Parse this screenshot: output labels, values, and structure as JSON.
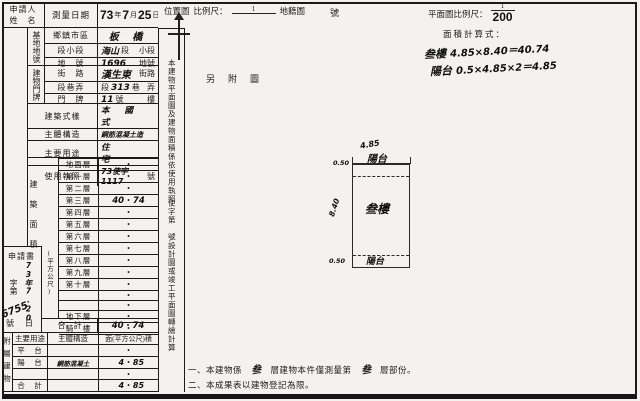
{
  "header": {
    "applicant_line1": "申請人",
    "applicant_line2": "姓　名",
    "survey_date_label": "測量日期",
    "date_year": "73",
    "date_year_unit": "年",
    "date_month": "7",
    "date_month_unit": "月",
    "date_day": "25",
    "date_day_unit": "日",
    "location_map_label": "位置圖",
    "location_scale_label": "比例尺：",
    "location_scale_numerator": "1",
    "location_scale_suffix": "地籍圖",
    "sheet_number_label": "號",
    "plan_scale_label": "平面圖比例尺：",
    "plan_scale_numerator": "1",
    "plan_scale_denominator": "200",
    "area_formula_label": "面積計算式：",
    "formula1_name": "叁樓",
    "formula1_expr": "4.85×8.40＝40.74",
    "formula2_name": "陽台",
    "formula2_expr": "0.5×4.85×2＝4.85",
    "attached_stamp": "另附圖"
  },
  "site": {
    "group_label": "基地地號",
    "district_label": "鄉鎮市區",
    "district_value": "板 橋",
    "section_label": "段小段",
    "section_hw": "海山",
    "section_p1": "段",
    "section_p2": "小段",
    "lot_label": "地　號",
    "lot_hw": "1696",
    "lot_suffix": "地號"
  },
  "address": {
    "group_label": "建物門牌",
    "street_label": "街　路",
    "street_hw": "漢生東",
    "street_suffix": "街路",
    "lane_label": "段巷弄",
    "lane_p0": "段",
    "lane_hw": "313",
    "lane_p1": "巷",
    "lane_p2": "弄",
    "door_label": "門　牌",
    "door_hw": "11",
    "door_p1": "號",
    "door_p2": "樓"
  },
  "building": {
    "style_label": "建築式樣",
    "style_value": "本 國 式",
    "struct_label": "主體構造",
    "struct_value": "鋼筋混凝土造",
    "use_label": "主要用途",
    "use_value": "住　宅",
    "license_label": "使用執照",
    "license_value": "73使字1117",
    "license_suffix": "號"
  },
  "floors": {
    "group_label": "建築面積",
    "unit_label": "(平方公尺)",
    "dot": "•",
    "rows": [
      {
        "label": "地面層",
        "pre": "",
        "post": ""
      },
      {
        "label": "第一層",
        "pre": "",
        "post": ""
      },
      {
        "label": "第二層",
        "pre": "",
        "post": ""
      },
      {
        "label": "第三層",
        "pre": "40",
        "post": "74"
      },
      {
        "label": "第四層",
        "pre": "",
        "post": ""
      },
      {
        "label": "第五層",
        "pre": "",
        "post": ""
      },
      {
        "label": "第六層",
        "pre": "",
        "post": ""
      },
      {
        "label": "第七層",
        "pre": "",
        "post": ""
      },
      {
        "label": "第八層",
        "pre": "",
        "post": ""
      },
      {
        "label": "第九層",
        "pre": "",
        "post": ""
      },
      {
        "label": "第十層",
        "pre": "",
        "post": ""
      },
      {
        "label": "",
        "pre": "",
        "post": ""
      },
      {
        "label": "",
        "pre": "",
        "post": ""
      },
      {
        "label": "地下層",
        "pre": "",
        "post": ""
      },
      {
        "label": "騎　樓",
        "pre": "",
        "post": ""
      }
    ],
    "total_label": "合　計",
    "total_pre": "40",
    "total_post": "74"
  },
  "application": {
    "title": "申請書",
    "zi_di": "字第",
    "number_hw": "6755",
    "hao": "號",
    "date_hw": "73年7.20",
    "ri": "日"
  },
  "annex": {
    "group_label": "附屬建物",
    "col_use": "主要用途",
    "col_struct": "主體構造",
    "col_area": "面(平方公尺)積",
    "rows": [
      {
        "use": "平　台",
        "struct": "",
        "pre": "",
        "post": ""
      },
      {
        "use": "陽　台",
        "struct": "鋼筋混凝土",
        "pre": "4",
        "post": "85"
      },
      {
        "use": "",
        "struct": "",
        "pre": "",
        "post": ""
      },
      {
        "use": "合　計",
        "struct": "",
        "pre": "4",
        "post": "85"
      }
    ]
  },
  "strip": {
    "part1": "本建物平面圖及建物面積係依使用執照",
    "part2": "使字第",
    "part3": "號設計圖或竣工平面圖轉繪計算"
  },
  "notes": {
    "n1_a": "一、本建物係",
    "n1_hw1": "叁",
    "n1_b": "層建物本件僅測量第",
    "n1_hw2": "叁",
    "n1_c": "層部份。",
    "n2": "二、本成果表以建物登記為限。"
  },
  "plan": {
    "top_dim": "4.85",
    "top_label": "陽台",
    "dim_top_left": "0.50",
    "dim_left": "8.40",
    "dim_bottom_left": "0.50",
    "center_label": "叁樓",
    "bottom_label": "陽台"
  },
  "colors": {
    "paper": "#f3f2ef",
    "ink": "#1a1a1a"
  }
}
